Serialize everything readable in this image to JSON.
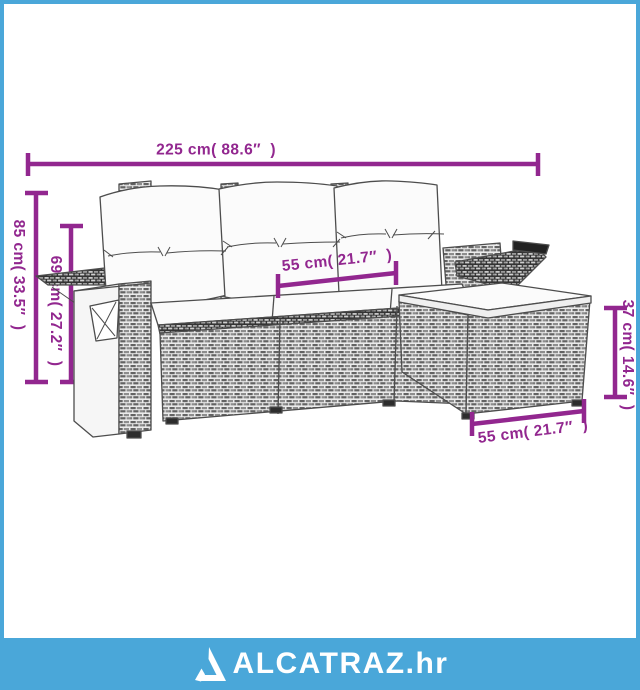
{
  "dimensions": {
    "top_width": {
      "label": "225 cm( 88.6″  )"
    },
    "height_outer": {
      "label": "85 cm( 33.5″  )"
    },
    "height_arm": {
      "label": "69 cm( 27.2″  )"
    },
    "seat_width": {
      "label": "55 cm( 21.7″  )"
    },
    "stool_height": {
      "label": "37 cm( 14.6″  )"
    },
    "stool_width": {
      "label": "55 cm( 21.7″  )"
    }
  },
  "watermark": {
    "logo_icon": "triangle-a-icon",
    "logo_text": "ALCATRAZ.hr"
  },
  "colors": {
    "dimension": "#92278f",
    "frame_border": "#4aa7d9",
    "watermark_bar": "#4aa7d9",
    "logo_text": "#ffffff"
  }
}
